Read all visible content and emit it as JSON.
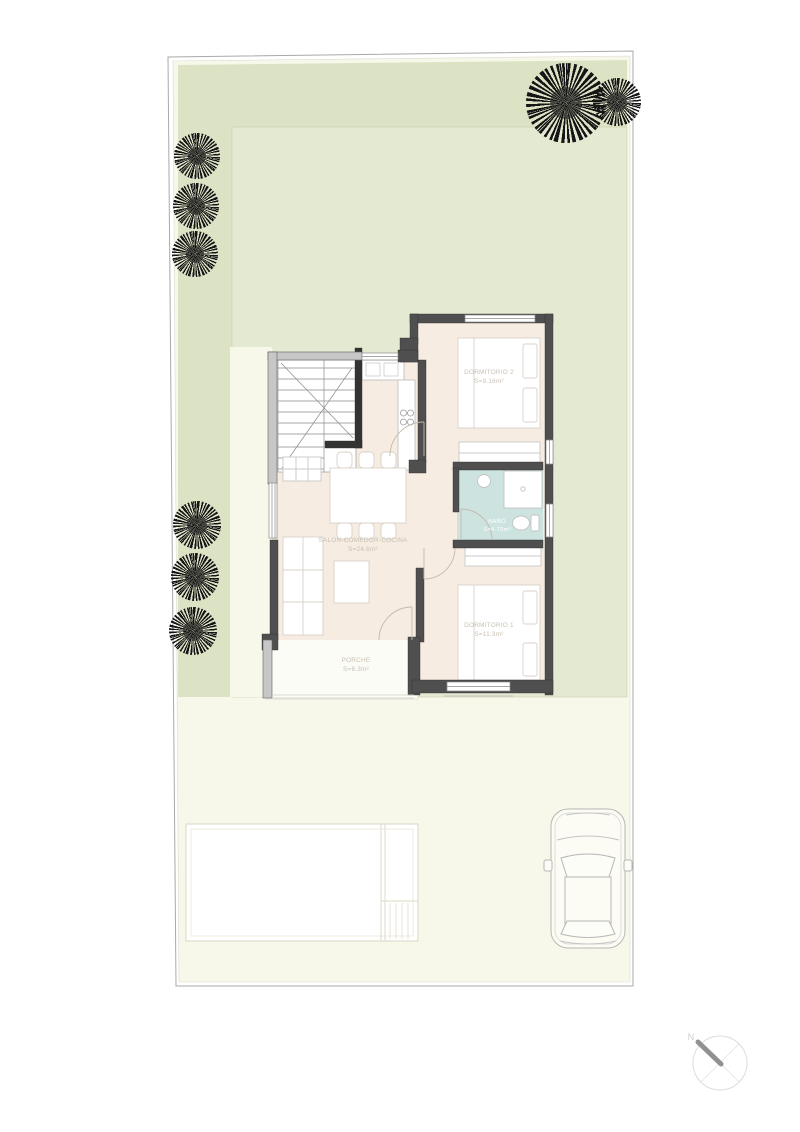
{
  "plan": {
    "colors": {
      "plot_ivory": "#f8f8ea",
      "garden": "#dce3c5",
      "garden_light": "#e4e9d2",
      "floor": "#f6ece2",
      "bath": "#cde3e0",
      "wall_dark": "#4f4f4f",
      "wall_light": "#c7c7c7",
      "tree": "#161616",
      "porch_slab": "#fcfcf6"
    },
    "rooms": {
      "dormitorio2": {
        "label": "DORMITORIO 2",
        "area": "S=9.16m²"
      },
      "salon": {
        "label": "SALON-COMEDOR-COCINA",
        "area": "S=24.6m²"
      },
      "bano": {
        "label": "BAÑO",
        "area": "S=4.70m²"
      },
      "dormitorio1": {
        "label": "DORMITORIO 1",
        "area": "S=11.3m²"
      },
      "porche": {
        "label": "PORCHE",
        "area": "S=6.3m²"
      }
    },
    "compass": {
      "north": "N"
    }
  }
}
